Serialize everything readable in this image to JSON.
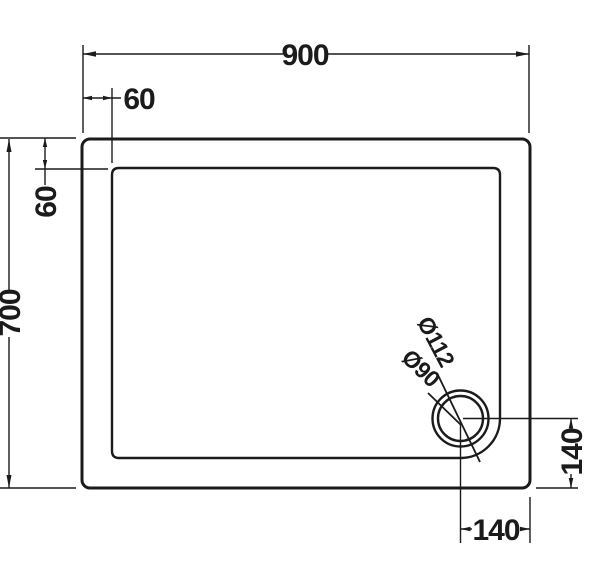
{
  "figure": {
    "type": "technical-drawing-shower-tray-plan",
    "line_color": "#1b1b1b",
    "background_color": "#ffffff",
    "labels": {
      "overall_width": "900",
      "edge_offset_top": "60",
      "edge_offset_left": "60",
      "overall_depth": "700",
      "waste_outer_diameter": "Ø112",
      "waste_inner_diameter": "Ø90",
      "waste_offset_right": "140",
      "waste_offset_bottom": "140"
    }
  }
}
